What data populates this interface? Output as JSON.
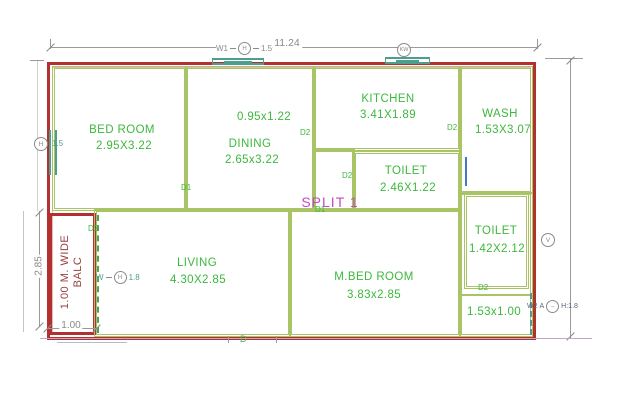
{
  "title": "residential floor plan (SPLIT 1)",
  "colors": {
    "outer_wall": "#b23030",
    "outer_wall_inner": "#e9b6b6",
    "interior_wall": "#a9c465",
    "room_text": "#3cb83c",
    "window": "#4e9e8e",
    "balc_door": "#569a62",
    "dim_text": "#8a8a8a",
    "dim_line": "#9a9a9a",
    "split_text": "#c44ac4",
    "balc_text": "#9a4040",
    "section_line": "#c0a8cc",
    "blue_window": "#4876c8"
  },
  "rooms": [
    {
      "name": "BED ROOM",
      "size": "2.95X3.22"
    },
    {
      "name": "DINING",
      "size": "2.65x3.22"
    },
    {
      "name": "KITCHEN",
      "size": "3.41X1.89"
    },
    {
      "name": "WASH",
      "size": "1.53X3.07"
    },
    {
      "name": "TOILET",
      "size": "2.46X1.22"
    },
    {
      "name": "LIVING",
      "size": "4.30X2.85"
    },
    {
      "name": "M.BED ROOM",
      "size": "3.83x2.85"
    },
    {
      "name": "TOILET",
      "size": "1.42X2.12"
    }
  ],
  "labels": {
    "passage_size": "0.95x1.22",
    "corner_size": "1.53x1.00",
    "split": "SPLIT 1",
    "balcony_line1": "1.00 M. WIDE",
    "balcony_line2": "BALC"
  },
  "dimensions": {
    "top_width": "11.24",
    "living_depth": "2.85",
    "balcony_width": "1.00"
  },
  "markers": {
    "top_window": {
      "prefix": "W1",
      "bubble": "H",
      "suffix": "1.5"
    },
    "left_window": {
      "bubble": "H",
      "suffix": "1.5"
    },
    "kitchen_window": {
      "bubble": "KW"
    },
    "vent": {
      "bubble": "V"
    },
    "balcony_window": {
      "prefix": "W",
      "bubble": "H",
      "suffix": "1.8"
    },
    "corner_window": {
      "prefix": "W2",
      "mid": "A",
      "bubble": "–",
      "suffix": "H:1.8"
    }
  },
  "door_tags": {
    "bedroom": "D1",
    "split": "D1",
    "balcony": "D2",
    "kitchen": "D2",
    "corridor": "D2",
    "wash": "D2",
    "toilet": "D2",
    "bottom": "D"
  }
}
